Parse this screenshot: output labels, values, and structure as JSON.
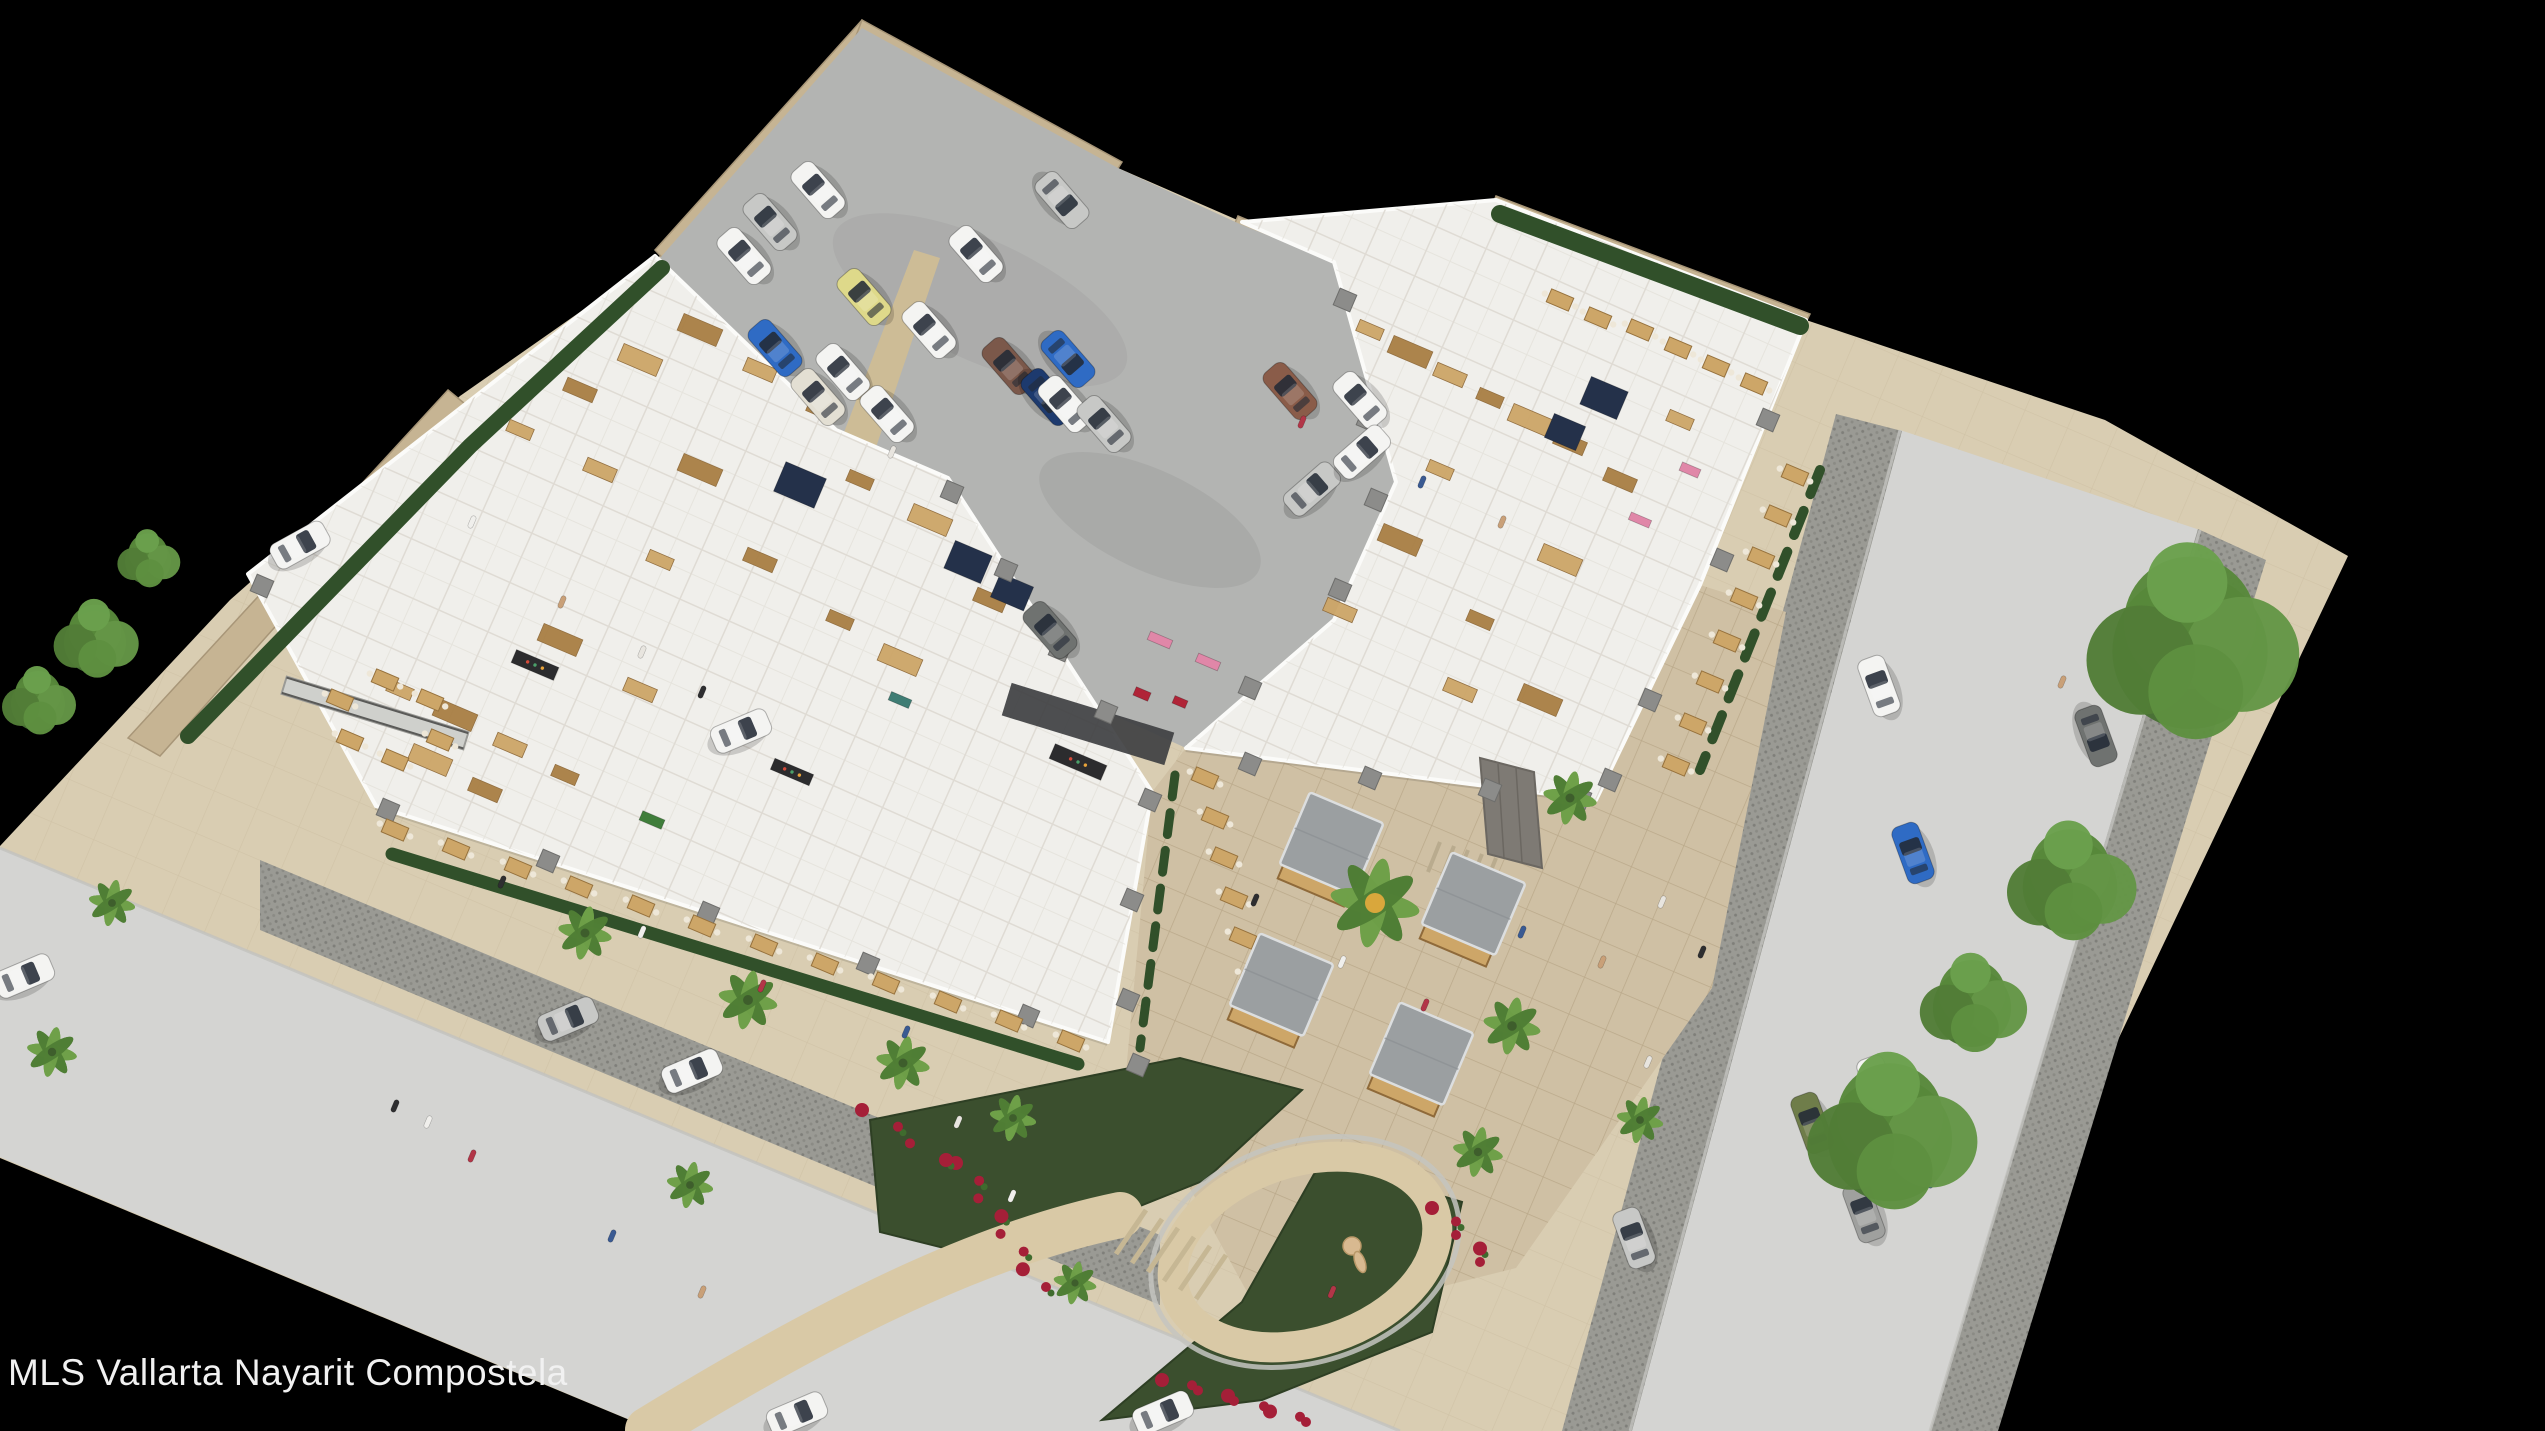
{
  "caption": {
    "text": "MLS Vallarta Nayarit Compostela"
  },
  "scene": {
    "subject": "Aerial 3D cutaway rendering of a single-story commercial plaza",
    "features": [
      "parking lot with cars",
      "cutaway retail and restaurant interiors",
      "central courtyard with four food kiosks and palm trees",
      "entry garden with looping path and animal sculpture",
      "perimeter streets with parked and moving cars",
      "street trees and hedges"
    ],
    "background": "black"
  },
  "palette": {
    "bg": "#000000",
    "street": "#d4d4d2",
    "cobble": "#9a9a94",
    "sidewalk": "#d9cdb2",
    "sidewalkLine": "#c9bb9e",
    "courtyard": "#cfc0a4",
    "courtyardLine": "#b5a384",
    "concrete": "#b3b4b2",
    "wallTan": "#c6b493",
    "wallTanDark": "#a89678",
    "hedge": "#31502a",
    "building": "#f0efeb",
    "roomLine": "#dcd8d0",
    "wood": "#cda668",
    "woodDark": "#a97f44",
    "grayCol": "#8c8c8a",
    "navy": "#24314a",
    "roofGray": "#9b9fa1",
    "stoneGray": "#7e7a74",
    "flowerRed": "#a51f38",
    "pathSand": "#d9c9a6",
    "gardenGreen": "#3b4f2e",
    "sculpture": "#d8b990",
    "walkstrip": "#cdbc96"
  },
  "carColors": {
    "white": "#f4f4f2",
    "silver": "#c7c8c6",
    "blue": "#2f6bc4",
    "navy": "#1d3a6e",
    "yellow": "#ded98a",
    "brown": "#7b584a",
    "beige": "#e3dfd3",
    "bronze": "#8a5c49",
    "green": "#6f7d4a",
    "gray": "#9fa09e",
    "graydark": "#6f7270"
  },
  "accentColors": {
    "navy": "#24314a",
    "dark": "#2c2c2e",
    "green": "#3f7d3a",
    "red": "#b02437",
    "pink": "#e087a8",
    "teal": "#3f7d74"
  },
  "peopleColors": [
    "#2e2e30",
    "#f0efec",
    "#b23648",
    "#3a5a92",
    "#c9a078",
    "#e8e5df"
  ],
  "elements": {
    "cars": [
      [
        818,
        190,
        -41,
        "white"
      ],
      [
        770,
        222,
        -41,
        "silver"
      ],
      [
        744,
        256,
        -41,
        "white"
      ],
      [
        775,
        348,
        -41,
        "blue"
      ],
      [
        864,
        297,
        -41,
        "yellow"
      ],
      [
        843,
        372,
        -41,
        "white"
      ],
      [
        976,
        254,
        -41,
        "white"
      ],
      [
        1062,
        200,
        139,
        "silver"
      ],
      [
        929,
        330,
        -41,
        "white"
      ],
      [
        1009,
        366,
        -41,
        "brown"
      ],
      [
        1068,
        359,
        139,
        "blue"
      ],
      [
        1048,
        397,
        139,
        "navy"
      ],
      [
        887,
        414,
        -41,
        "white"
      ],
      [
        818,
        397,
        -41,
        "beige"
      ],
      [
        1065,
        404,
        -41,
        "white"
      ],
      [
        1104,
        424,
        -41,
        "silver"
      ],
      [
        1290,
        391,
        -41,
        "bronze"
      ],
      [
        1360,
        400,
        -41,
        "white"
      ],
      [
        1312,
        489,
        49,
        "silver"
      ],
      [
        1362,
        452,
        49,
        "white"
      ],
      [
        1050,
        630,
        -41,
        "graydark"
      ],
      [
        741,
        731,
        67,
        "white"
      ],
      [
        300,
        545,
        61,
        "white"
      ],
      [
        24,
        976,
        67,
        "white"
      ],
      [
        568,
        1019,
        67,
        "silver"
      ],
      [
        692,
        1071,
        67,
        "white"
      ],
      [
        797,
        1414,
        67,
        "white"
      ],
      [
        1163,
        1413,
        67,
        "white"
      ],
      [
        1879,
        686,
        -20,
        "white"
      ],
      [
        1913,
        853,
        -20,
        "blue"
      ],
      [
        2096,
        736,
        160,
        "graydark"
      ],
      [
        2079,
        896,
        160,
        "silver"
      ],
      [
        1634,
        1238,
        -20,
        "silver"
      ],
      [
        1812,
        1123,
        -20,
        "green"
      ],
      [
        1878,
        1086,
        -20,
        "white"
      ],
      [
        1864,
        1212,
        -20,
        "gray"
      ]
    ],
    "palms": [
      [
        1375,
        903,
        50,
        1
      ],
      [
        1570,
        798,
        30,
        0
      ],
      [
        1512,
        1026,
        32,
        0
      ],
      [
        1478,
        1152,
        28,
        0
      ],
      [
        585,
        933,
        30,
        0
      ],
      [
        748,
        1000,
        33,
        0
      ],
      [
        903,
        1063,
        30,
        0
      ],
      [
        1013,
        1118,
        26,
        0
      ],
      [
        112,
        903,
        26,
        0
      ],
      [
        52,
        1052,
        28,
        0
      ],
      [
        690,
        1185,
        26,
        0
      ],
      [
        1075,
        1283,
        24,
        0
      ],
      [
        1640,
        1120,
        26,
        0
      ]
    ],
    "trees": [
      [
        2190,
        640,
        115
      ],
      [
        2070,
        880,
        70
      ],
      [
        1890,
        1130,
        92
      ],
      [
        1972,
        1002,
        58
      ],
      [
        95,
        638,
        46
      ],
      [
        148,
        558,
        34
      ],
      [
        38,
        700,
        40
      ]
    ],
    "kiosks": [
      [
        1328,
        852
      ],
      [
        1470,
        912
      ],
      [
        1278,
        993
      ],
      [
        1418,
        1062
      ]
    ],
    "tables": [
      [
        395,
        830
      ],
      [
        456,
        849
      ],
      [
        518,
        868
      ],
      [
        579,
        887
      ],
      [
        641,
        906
      ],
      [
        702,
        926
      ],
      [
        764,
        945
      ],
      [
        825,
        964
      ],
      [
        886,
        983
      ],
      [
        948,
        1002
      ],
      [
        1009,
        1021
      ],
      [
        1071,
        1041
      ],
      [
        1795,
        475
      ],
      [
        1778,
        516
      ],
      [
        1761,
        558
      ],
      [
        1744,
        599
      ],
      [
        1727,
        641
      ],
      [
        1710,
        682
      ],
      [
        1693,
        724
      ],
      [
        1676,
        765
      ],
      [
        1205,
        778
      ],
      [
        1215,
        818
      ],
      [
        1224,
        858
      ],
      [
        1234,
        898
      ],
      [
        1243,
        938
      ],
      [
        1253,
        978
      ],
      [
        1262,
        1018
      ],
      [
        340,
        700
      ],
      [
        385,
        680
      ],
      [
        430,
        700
      ],
      [
        350,
        740
      ],
      [
        395,
        760
      ],
      [
        440,
        740
      ],
      [
        1640,
        330
      ],
      [
        1678,
        348
      ],
      [
        1716,
        366
      ],
      [
        1754,
        384
      ],
      [
        1560,
        300
      ],
      [
        1598,
        318
      ]
    ],
    "columns": [
      [
        388,
        810
      ],
      [
        548,
        861
      ],
      [
        708,
        913
      ],
      [
        868,
        964
      ],
      [
        1028,
        1016
      ],
      [
        952,
        492
      ],
      [
        1006,
        570
      ],
      [
        1060,
        650
      ],
      [
        1106,
        712
      ],
      [
        1345,
        300
      ],
      [
        1368,
        420
      ],
      [
        1376,
        500
      ],
      [
        1340,
        590
      ],
      [
        1250,
        688
      ],
      [
        1250,
        764
      ],
      [
        1370,
        778
      ],
      [
        1490,
        790
      ],
      [
        1580,
        798
      ],
      [
        1150,
        800
      ],
      [
        1132,
        900
      ],
      [
        1128,
        1000
      ],
      [
        1138,
        1065
      ],
      [
        1768,
        420
      ],
      [
        1722,
        560
      ],
      [
        1650,
        700
      ],
      [
        1610,
        780
      ],
      [
        262,
        586
      ]
    ],
    "furniture": [
      [
        700,
        330
      ],
      [
        760,
        370
      ],
      [
        820,
        410
      ],
      [
        640,
        360
      ],
      [
        580,
        390
      ],
      [
        520,
        430
      ],
      [
        700,
        470
      ],
      [
        600,
        470
      ],
      [
        860,
        480
      ],
      [
        930,
        520
      ],
      [
        760,
        560
      ],
      [
        660,
        560
      ],
      [
        560,
        640
      ],
      [
        640,
        690
      ],
      [
        840,
        620
      ],
      [
        900,
        660
      ],
      [
        990,
        600
      ],
      [
        400,
        690
      ],
      [
        455,
        715
      ],
      [
        510,
        745
      ],
      [
        565,
        775
      ],
      [
        430,
        760
      ],
      [
        485,
        790
      ],
      [
        1370,
        330
      ],
      [
        1410,
        352
      ],
      [
        1450,
        375
      ],
      [
        1490,
        398
      ],
      [
        1530,
        420
      ],
      [
        1570,
        443
      ],
      [
        1440,
        470
      ],
      [
        1400,
        540
      ],
      [
        1340,
        610
      ],
      [
        1480,
        620
      ],
      [
        1560,
        560
      ],
      [
        1620,
        480
      ],
      [
        1680,
        420
      ],
      [
        1540,
        700
      ],
      [
        1460,
        690
      ]
    ],
    "accents": [
      [
        968,
        562,
        40,
        30,
        "navy"
      ],
      [
        1012,
        592,
        36,
        26,
        "navy"
      ],
      [
        800,
        485,
        44,
        32,
        "navy"
      ],
      [
        1604,
        398,
        40,
        30,
        "navy"
      ],
      [
        1565,
        432,
        34,
        26,
        "navy"
      ],
      [
        1078,
        762,
        56,
        16,
        "dark"
      ],
      [
        535,
        665,
        46,
        14,
        "dark"
      ],
      [
        792,
        772,
        42,
        12,
        "dark"
      ],
      [
        652,
        820,
        24,
        10,
        "green"
      ],
      [
        1690,
        470,
        20,
        9,
        "pink"
      ],
      [
        1160,
        640,
        24,
        9,
        "pink"
      ],
      [
        1208,
        662,
        24,
        9,
        "pink"
      ],
      [
        1640,
        520,
        22,
        8,
        "pink"
      ],
      [
        1142,
        694,
        16,
        9,
        "red"
      ],
      [
        1180,
        702,
        14,
        8,
        "red"
      ],
      [
        900,
        700,
        22,
        9,
        "teal"
      ]
    ],
    "flowerRows": [
      [
        962,
        1163,
        1040,
        1287,
        8
      ],
      [
        1168,
        1380,
        1312,
        1422,
        9
      ],
      [
        1438,
        1208,
        1486,
        1262,
        5
      ],
      [
        868,
        1110,
        940,
        1160,
        4
      ]
    ],
    "people": [
      [
        1255,
        900
      ],
      [
        1342,
        962
      ],
      [
        1425,
        1005
      ],
      [
        1522,
        932
      ],
      [
        1602,
        962
      ],
      [
        1648,
        1062
      ],
      [
        395,
        1106
      ],
      [
        428,
        1122
      ],
      [
        472,
        1156
      ],
      [
        612,
        1236
      ],
      [
        702,
        1292
      ],
      [
        958,
        1122
      ],
      [
        502,
        882
      ],
      [
        642,
        932
      ],
      [
        762,
        986
      ],
      [
        906,
        1032
      ],
      [
        562,
        602
      ],
      [
        642,
        652
      ],
      [
        702,
        692
      ],
      [
        472,
        522
      ],
      [
        1302,
        422
      ],
      [
        1422,
        482
      ],
      [
        1502,
        522
      ],
      [
        1662,
        902
      ],
      [
        1702,
        952
      ],
      [
        1012,
        1196
      ],
      [
        1332,
        1292
      ],
      [
        1932,
        1182
      ],
      [
        2062,
        682
      ],
      [
        892,
        452
      ]
    ]
  }
}
